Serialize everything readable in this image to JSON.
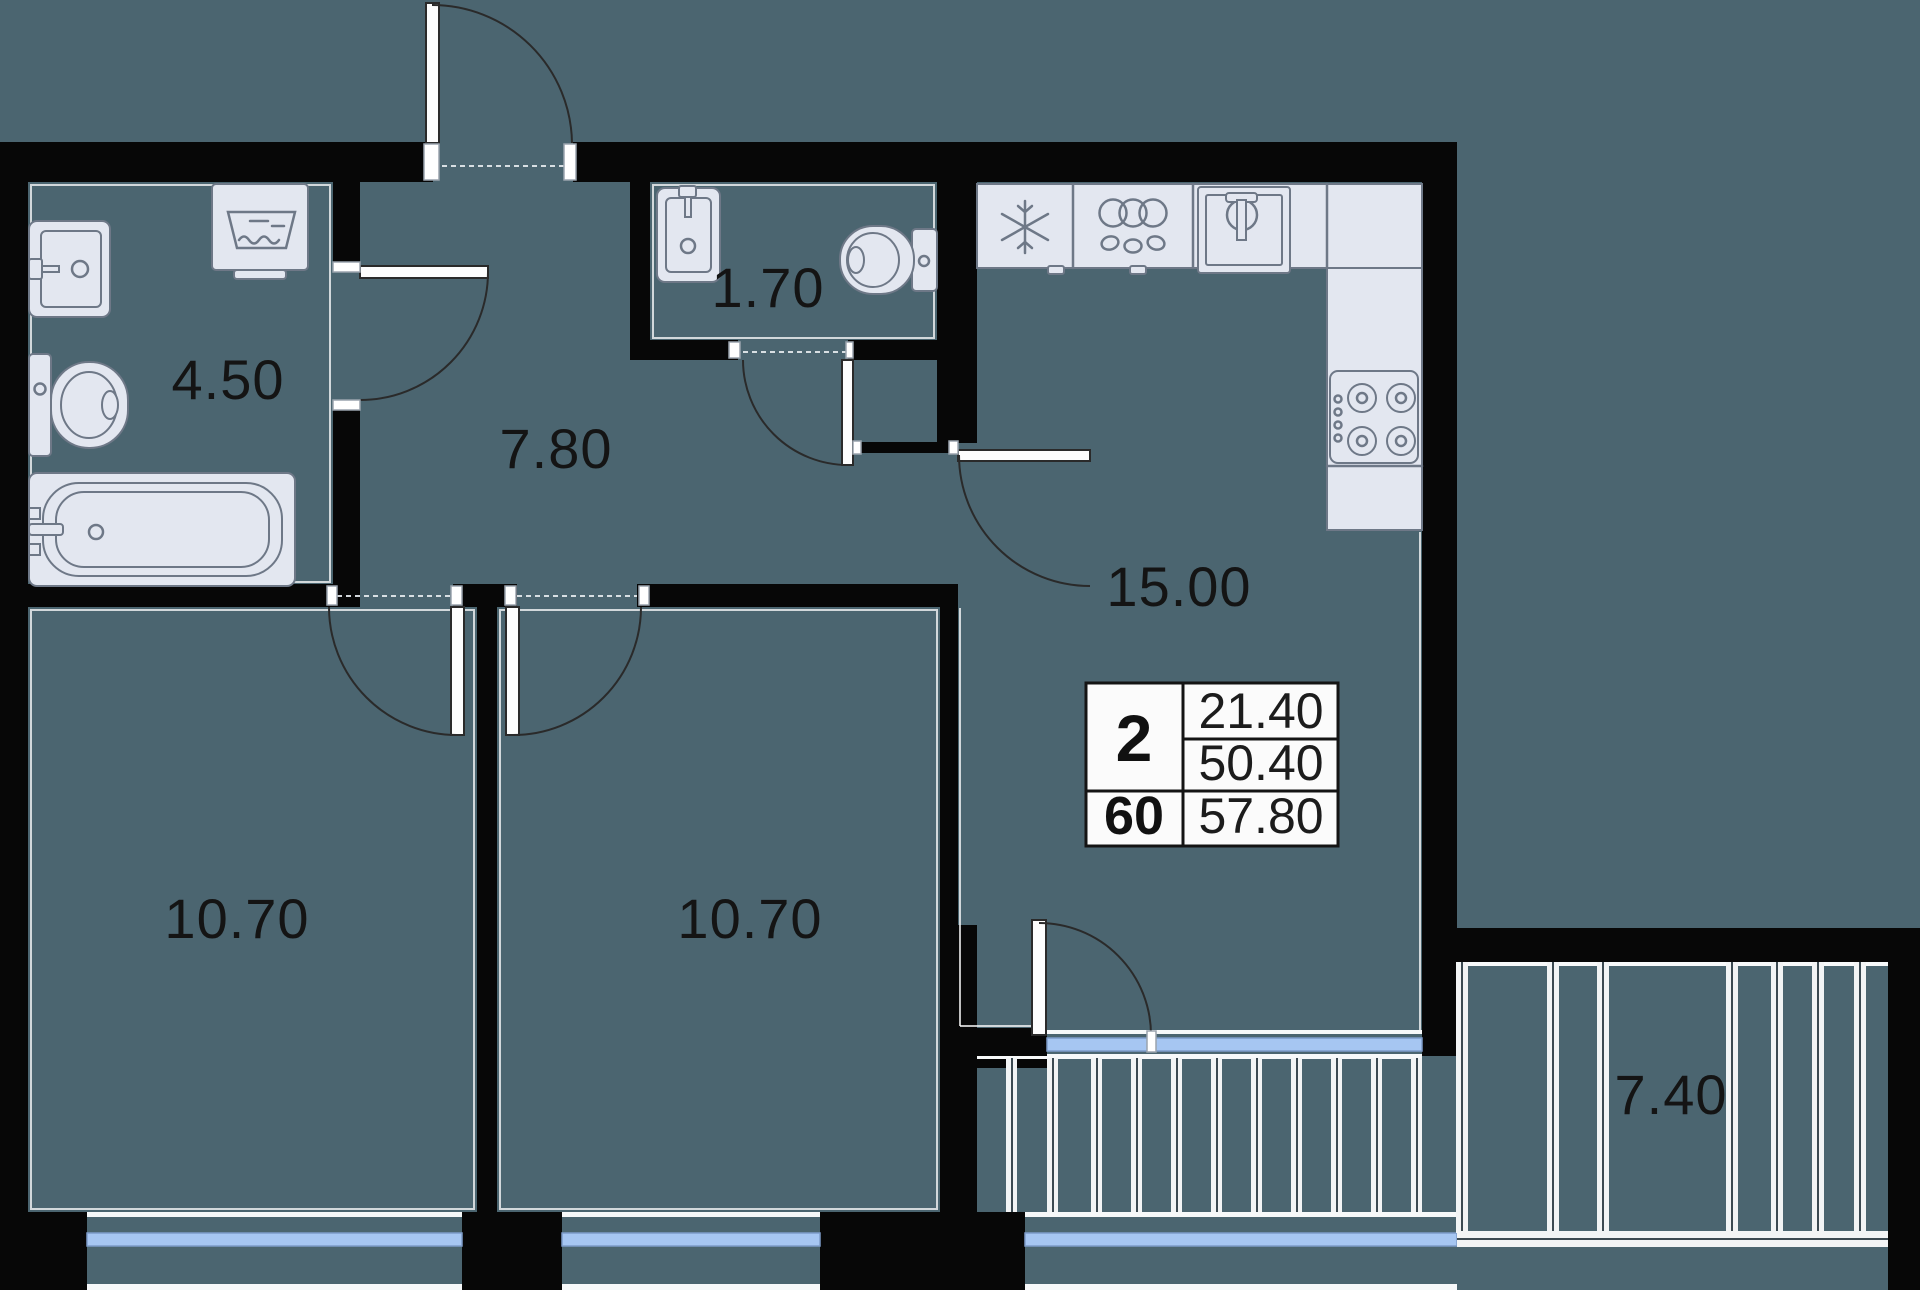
{
  "plan": {
    "colors": {
      "background": "#4b6570",
      "walls": "#070707",
      "fixtures": "#e3e7f0",
      "window": "#a6c6f2",
      "info_box_bg": "#fbfbfb"
    },
    "rooms": {
      "bathroom": {
        "area": "4.50"
      },
      "hallway": {
        "area": "7.80"
      },
      "wc": {
        "area": "1.70"
      },
      "kitchen_living": {
        "area": "15.00"
      },
      "bedroom_left": {
        "area": "10.70"
      },
      "bedroom_middle": {
        "area": "10.70"
      },
      "balcony": {
        "area": "7.40"
      }
    },
    "info_box": {
      "rooms_count": "2",
      "unit_number": "60",
      "area_top": "21.40",
      "area_middle": "50.40",
      "area_bottom": "57.80"
    }
  }
}
